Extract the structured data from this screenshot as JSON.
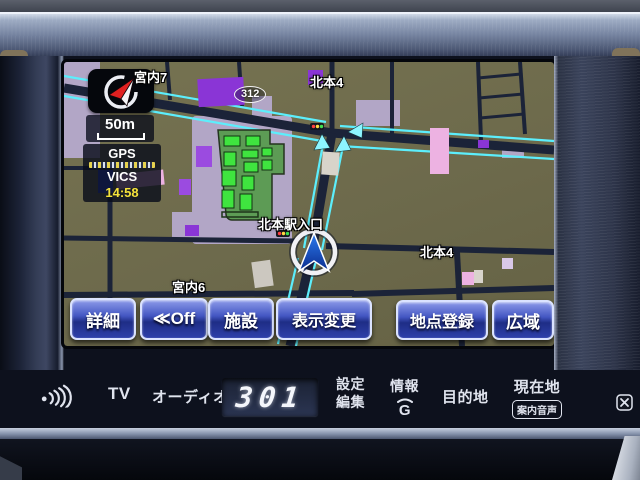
{
  "nav": {
    "status": {
      "scale": "50m",
      "gps": "GPS",
      "vics": "VICS",
      "time": "14:58"
    },
    "labels": {
      "area_nw": "宮内7",
      "route": "312",
      "junction_north": "北本4",
      "station_entrance": "北本駅入口",
      "area_sw": "宮内6",
      "junction_east": "北本4"
    },
    "buttons": {
      "detail": "詳細",
      "off": "≪Off",
      "facility": "施設",
      "display_change": "表示変更",
      "register_point": "地点登録",
      "wide": "広域"
    }
  },
  "panel": {
    "tv": "TV",
    "audio": "オーディオ",
    "display": "301",
    "settings_top": "設定",
    "settings_bottom": "編集",
    "info": "情報",
    "info_icon": "G",
    "destination": "目的地",
    "current_location": "現在地",
    "guidance_voice": "案内音声"
  },
  "colors": {
    "map_bg": "#6f6c4e",
    "road": "#1b2338",
    "traffic_cyan": "#5ceefc",
    "button_blue": "#2b3da0",
    "time_yellow": "#f5e23a"
  }
}
